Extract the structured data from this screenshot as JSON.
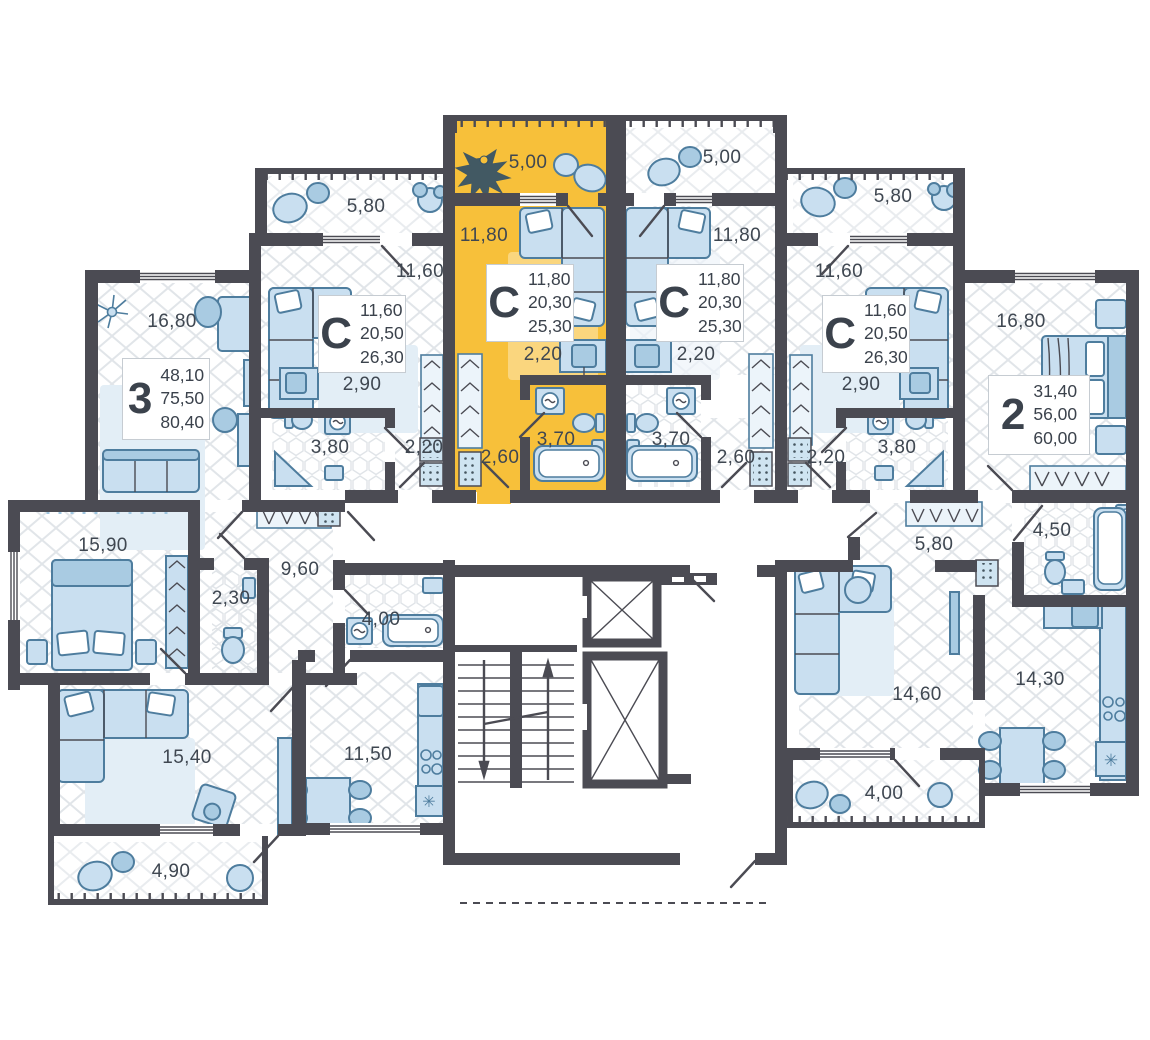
{
  "plan": {
    "highlight_color": "#f7c03a",
    "wall_color": "#4b4b53",
    "furniture_color": "#c9dff0",
    "floor_hatch_color": "#e1e5e9"
  },
  "core": {
    "stairs": true,
    "elevator_count": 2
  },
  "apartments": [
    {
      "id": "apt-3-room",
      "label": "3",
      "highlighted": false,
      "area_values": [
        "48,10",
        "75,50",
        "80,40"
      ],
      "rooms": [
        {
          "name": "bedroom-top",
          "area": "16,80"
        },
        {
          "name": "bedroom",
          "area": "15,90"
        },
        {
          "name": "wc",
          "area": "2,30"
        },
        {
          "name": "hallway",
          "area": "9,60"
        },
        {
          "name": "bathroom",
          "area": "4,00"
        },
        {
          "name": "kitchen",
          "area": "11,50"
        },
        {
          "name": "living-room",
          "area": "15,40"
        },
        {
          "name": "balcony",
          "area": "4,90"
        }
      ]
    },
    {
      "id": "studio-left",
      "label": "С",
      "highlighted": false,
      "area_values": [
        "11,60",
        "20,50",
        "26,30"
      ],
      "rooms": [
        {
          "name": "balcony",
          "area": "5,80"
        },
        {
          "name": "room",
          "area": "11,60"
        },
        {
          "name": "kitchen",
          "area": "2,90"
        },
        {
          "name": "bathroom",
          "area": "3,80"
        },
        {
          "name": "hallway",
          "area": "2,20"
        }
      ]
    },
    {
      "id": "studio-highlighted",
      "label": "С",
      "highlighted": true,
      "area_values": [
        "11,80",
        "20,30",
        "25,30"
      ],
      "rooms": [
        {
          "name": "balcony",
          "area": "5,00"
        },
        {
          "name": "room",
          "area": "11,80"
        },
        {
          "name": "kitchen",
          "area": "2,20"
        },
        {
          "name": "bathroom",
          "area": "3,70"
        },
        {
          "name": "hallway",
          "area": "2,60"
        }
      ]
    },
    {
      "id": "studio-center-right",
      "label": "С",
      "highlighted": false,
      "area_values": [
        "11,80",
        "20,30",
        "25,30"
      ],
      "rooms": [
        {
          "name": "balcony",
          "area": "5,00"
        },
        {
          "name": "room",
          "area": "11,80"
        },
        {
          "name": "kitchen",
          "area": "2,20"
        },
        {
          "name": "bathroom",
          "area": "3,70"
        },
        {
          "name": "hallway",
          "area": "2,60"
        }
      ]
    },
    {
      "id": "studio-right",
      "label": "С",
      "highlighted": false,
      "area_values": [
        "11,60",
        "20,50",
        "26,30"
      ],
      "rooms": [
        {
          "name": "balcony",
          "area": "5,80"
        },
        {
          "name": "room",
          "area": "11,60"
        },
        {
          "name": "kitchen",
          "area": "2,90"
        },
        {
          "name": "bathroom",
          "area": "3,80"
        },
        {
          "name": "hallway",
          "area": "2,20"
        }
      ]
    },
    {
      "id": "apt-2-room",
      "label": "2",
      "highlighted": false,
      "area_values": [
        "31,40",
        "56,00",
        "60,00"
      ],
      "rooms": [
        {
          "name": "bedroom",
          "area": "16,80"
        },
        {
          "name": "hallway",
          "area": "5,80"
        },
        {
          "name": "bathroom",
          "area": "4,50"
        },
        {
          "name": "living-room",
          "area": "14,60"
        },
        {
          "name": "kitchen",
          "area": "14,30"
        },
        {
          "name": "balcony",
          "area": "4,00"
        }
      ]
    }
  ]
}
